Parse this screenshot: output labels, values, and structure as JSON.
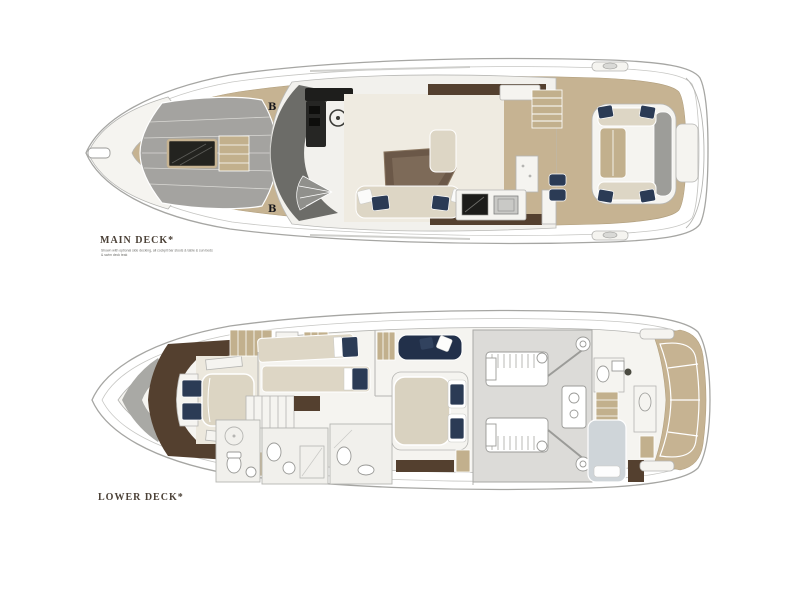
{
  "page": {
    "background": "#ffffff",
    "type": "yacht-floorplan-drawing"
  },
  "labels": {
    "main_deck": "MAIN DECK*",
    "lower_deck": "LOWER DECK*",
    "main_deck_note_line1": "Shown with optional side decking, all cockpit bar stools & table & sun beds",
    "main_deck_note_line2": "& swim deck teak"
  },
  "markers": {
    "bow_top": "B",
    "bow_bottom": "B"
  },
  "colors": {
    "teak_deck": "#c6b392",
    "dark_wood_floor": "#54402f",
    "table_wood": "#6b5848",
    "cream_upholstery": "#ddd6c5",
    "salon_floor": "#efebe1",
    "navy_upholstery": "#2b3b55",
    "helm_seat_navy": "#263650",
    "sunpad_gray": "#a4a3a0",
    "windshield_gray": "#6c6c68",
    "engine_room_gray": "#dcdbd8",
    "crew_bed_gray": "#cfd5d9",
    "hull_line_gray": "#a6a6a3",
    "label_text": "#4b4137",
    "skylight_black": "#23231f"
  }
}
